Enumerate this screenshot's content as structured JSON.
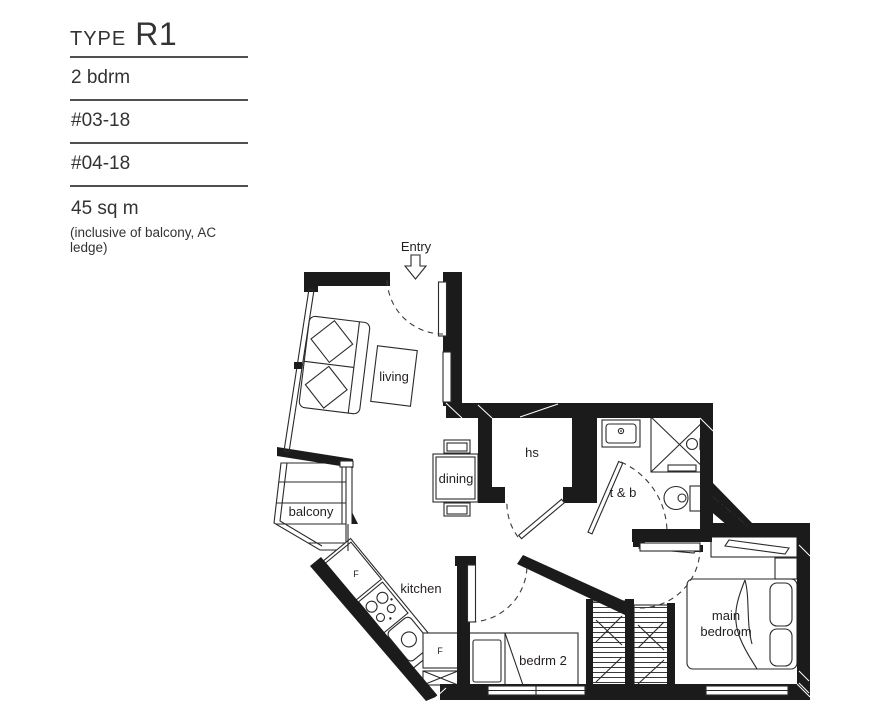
{
  "header": {
    "type_label": "TYPE",
    "type_value": "R1",
    "bedroom_type": "2 bdrm",
    "unit_numbers": [
      "#03-18",
      "#04-18"
    ],
    "area": "45 sq m",
    "area_note": "(inclusive of balcony, AC ledge)"
  },
  "plan": {
    "entry_label": "Entry",
    "labels": {
      "living": "living",
      "dining": "dining",
      "hs": "hs",
      "toilet_bath": "t & b",
      "balcony": "balcony",
      "kitchen": "kitchen",
      "bedroom2": "bedrm 2",
      "main_bedroom_line1": "main",
      "main_bedroom_line2": "bedroom",
      "fridge1": "F",
      "fridge2": "F"
    }
  },
  "colors": {
    "wall": "#1b1b1b",
    "line": "#2a2a2a",
    "text": "#231f20",
    "underline": "#505050",
    "background": "#ffffff"
  }
}
